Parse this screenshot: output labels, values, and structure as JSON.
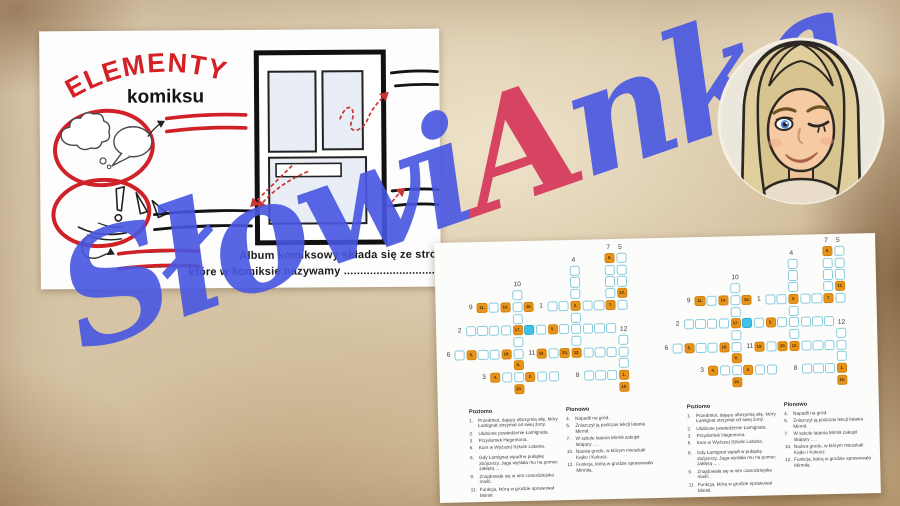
{
  "worksheet": {
    "title": "ELEMENTY",
    "subtitle": "komiksu",
    "album_line1": "Album komiksowy składa się ze stron,",
    "album_line2": "które w komiksie nazywamy ...................................................."
  },
  "watermark": {
    "text_before": "Słowi",
    "accent_letter": "A",
    "text_after": "nka",
    "blue": "#4856e2",
    "red": "#d63358"
  },
  "avatar": {
    "description": "bitmoji-blonde-woman-winking"
  },
  "crossword": {
    "colors": {
      "cell_border": "#87ccdd",
      "orange": "#e8941c",
      "highlight": "#41c2ea",
      "paper": "#fcfcfb"
    },
    "cells": [
      {
        "r": 0,
        "c": 13,
        "k": "o",
        "n": "9."
      },
      {
        "r": 0,
        "c": 14,
        "k": "w"
      },
      {
        "r": 1,
        "c": 10,
        "k": "w"
      },
      {
        "r": 1,
        "c": 13,
        "k": "w"
      },
      {
        "r": 1,
        "c": 14,
        "k": "w"
      },
      {
        "r": 2,
        "c": 10,
        "k": "w"
      },
      {
        "r": 2,
        "c": 13,
        "k": "w"
      },
      {
        "r": 2,
        "c": 14,
        "k": "w"
      },
      {
        "r": 3,
        "c": 5,
        "k": "w"
      },
      {
        "r": 3,
        "c": 10,
        "k": "w"
      },
      {
        "r": 3,
        "c": 13,
        "k": "w"
      },
      {
        "r": 3,
        "c": 14,
        "k": "o",
        "n": "13."
      },
      {
        "r": 4,
        "c": 2,
        "k": "o",
        "n": "11."
      },
      {
        "r": 4,
        "c": 3,
        "k": "w"
      },
      {
        "r": 4,
        "c": 4,
        "k": "o",
        "n": "14."
      },
      {
        "r": 4,
        "c": 5,
        "k": "w"
      },
      {
        "r": 4,
        "c": 6,
        "k": "o",
        "n": "15."
      },
      {
        "r": 4,
        "c": 8,
        "k": "w"
      },
      {
        "r": 4,
        "c": 9,
        "k": "w"
      },
      {
        "r": 4,
        "c": 10,
        "k": "o",
        "n": "3."
      },
      {
        "r": 4,
        "c": 11,
        "k": "w"
      },
      {
        "r": 4,
        "c": 12,
        "k": "w"
      },
      {
        "r": 4,
        "c": 13,
        "k": "o",
        "n": "7."
      },
      {
        "r": 4,
        "c": 14,
        "k": "w"
      },
      {
        "r": 5,
        "c": 5,
        "k": "w"
      },
      {
        "r": 5,
        "c": 10,
        "k": "w"
      },
      {
        "r": 6,
        "c": 1,
        "k": "w"
      },
      {
        "r": 6,
        "c": 2,
        "k": "w"
      },
      {
        "r": 6,
        "c": 3,
        "k": "w"
      },
      {
        "r": 6,
        "c": 4,
        "k": "w"
      },
      {
        "r": 6,
        "c": 5,
        "k": "o",
        "n": "17."
      },
      {
        "r": 6,
        "c": 6,
        "k": "b"
      },
      {
        "r": 6,
        "c": 7,
        "k": "w"
      },
      {
        "r": 6,
        "c": 8,
        "k": "o",
        "n": "5."
      },
      {
        "r": 6,
        "c": 9,
        "k": "w"
      },
      {
        "r": 6,
        "c": 10,
        "k": "w"
      },
      {
        "r": 6,
        "c": 11,
        "k": "w"
      },
      {
        "r": 6,
        "c": 12,
        "k": "w"
      },
      {
        "r": 6,
        "c": 13,
        "k": "w"
      },
      {
        "r": 7,
        "c": 5,
        "k": "w"
      },
      {
        "r": 7,
        "c": 10,
        "k": "w"
      },
      {
        "r": 7,
        "c": 14,
        "k": "w"
      },
      {
        "r": 8,
        "c": 0,
        "k": "w"
      },
      {
        "r": 8,
        "c": 1,
        "k": "o",
        "n": "6."
      },
      {
        "r": 8,
        "c": 2,
        "k": "w"
      },
      {
        "r": 8,
        "c": 3,
        "k": "w"
      },
      {
        "r": 8,
        "c": 4,
        "k": "o",
        "n": "18."
      },
      {
        "r": 8,
        "c": 5,
        "k": "w"
      },
      {
        "r": 8,
        "c": 7,
        "k": "o",
        "n": "19."
      },
      {
        "r": 8,
        "c": 8,
        "k": "w"
      },
      {
        "r": 8,
        "c": 9,
        "k": "o",
        "n": "20."
      },
      {
        "r": 8,
        "c": 10,
        "k": "o",
        "n": "12."
      },
      {
        "r": 8,
        "c": 11,
        "k": "w"
      },
      {
        "r": 8,
        "c": 12,
        "k": "w"
      },
      {
        "r": 8,
        "c": 13,
        "k": "w"
      },
      {
        "r": 8,
        "c": 14,
        "k": "w"
      },
      {
        "r": 9,
        "c": 5,
        "k": "o",
        "n": "8."
      },
      {
        "r": 9,
        "c": 14,
        "k": "w"
      },
      {
        "r": 10,
        "c": 3,
        "k": "o",
        "n": "4."
      },
      {
        "r": 10,
        "c": 4,
        "k": "w"
      },
      {
        "r": 10,
        "c": 5,
        "k": "w"
      },
      {
        "r": 10,
        "c": 6,
        "k": "o",
        "n": "2."
      },
      {
        "r": 10,
        "c": 7,
        "k": "w"
      },
      {
        "r": 10,
        "c": 8,
        "k": "w"
      },
      {
        "r": 10,
        "c": 11,
        "k": "w"
      },
      {
        "r": 10,
        "c": 12,
        "k": "w"
      },
      {
        "r": 10,
        "c": 13,
        "k": "w"
      },
      {
        "r": 10,
        "c": 14,
        "k": "o",
        "n": "1."
      },
      {
        "r": 11,
        "c": 5,
        "k": "o",
        "n": "10."
      },
      {
        "r": 11,
        "c": 14,
        "k": "o",
        "n": "16."
      }
    ],
    "grid_labels": [
      {
        "t": "7",
        "r": 0,
        "c": 13,
        "s": "top"
      },
      {
        "t": "5",
        "r": 0,
        "c": 14,
        "s": "top"
      },
      {
        "t": "4",
        "r": 1,
        "c": 10,
        "s": "top"
      },
      {
        "t": "10",
        "r": 3,
        "c": 5,
        "s": "top"
      },
      {
        "t": "12",
        "r": 7,
        "c": 14,
        "s": "top"
      },
      {
        "t": "9",
        "r": 4,
        "c": 2,
        "s": "left"
      },
      {
        "t": "1",
        "r": 4,
        "c": 8,
        "s": "left"
      },
      {
        "t": "2",
        "r": 6,
        "c": 1,
        "s": "left"
      },
      {
        "t": "6",
        "r": 8,
        "c": 0,
        "s": "left"
      },
      {
        "t": "11",
        "r": 8,
        "c": 7,
        "s": "left"
      },
      {
        "t": "3",
        "r": 10,
        "c": 3,
        "s": "left"
      },
      {
        "t": "8",
        "r": 10,
        "c": 11,
        "s": "left"
      }
    ],
    "clues": {
      "poziomo_title": "Poziomo",
      "pionowo_title": "Pionowo",
      "poziomo": [
        {
          "n": "1.",
          "t": "Przedmiot, dający olbrzymią siłę, który Łamignat otrzymał od swej żony."
        },
        {
          "n": "2.",
          "t": "Ulubione powiedzenie Łamignata."
        },
        {
          "n": "3.",
          "t": "Przydomek Hegemona."
        },
        {
          "n": "6.",
          "t": "Kurs w Wyższej Szkole Latania."
        },
        {
          "n": "8.",
          "t": "Gdy Łamignat wpadł w pułapkę zbójcerzy, Jaga wysłała mu na pomoc zaklętą ... .",
          "gap": true
        },
        {
          "n": "9.",
          "t": "Znajdowała się w nim czarodziejska maść."
        },
        {
          "n": "11.",
          "t": "Funkcja, którą w grodzie sprawował Mirmił."
        }
      ],
      "pionowo": [
        {
          "n": "4.",
          "t": "Napadli na gród."
        },
        {
          "n": "5.",
          "t": "Zniszczył ją podczas lekcji latania Mirmił."
        },
        {
          "n": "7.",
          "t": "W szkole latania Mirmił zakupił latający ... ."
        },
        {
          "n": "10.",
          "t": "Nazwa grodu, w którym mieszkali Kajko i Kokosz."
        },
        {
          "n": "12.",
          "t": "Funkcja, którą w grodzie sprawowała Mirmiła."
        }
      ]
    }
  }
}
